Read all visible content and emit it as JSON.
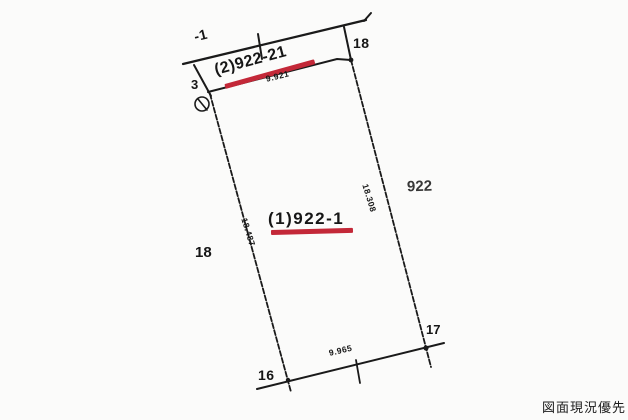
{
  "colors": {
    "line": "#1a1a1a",
    "underline_red": "#c32838",
    "stamp_text": "#1c1c1c",
    "background": "#fbfbfa"
  },
  "drawing": {
    "fragment_label": "-1",
    "boundary_points": {
      "top_right": "18",
      "left": "3",
      "left_mid": "18",
      "bottom_left": "16",
      "bottom_right": "17"
    },
    "parcels": {
      "strip_label": "(2)922-21",
      "main_label": "(1)922-1",
      "neighbor_right": "922"
    },
    "measurements": {
      "strip_width": "9.921",
      "left_edge": "18.487",
      "right_edge": "18.308",
      "bottom_edge": "9.965"
    }
  },
  "stamp": {
    "text": "図面現況優先"
  }
}
